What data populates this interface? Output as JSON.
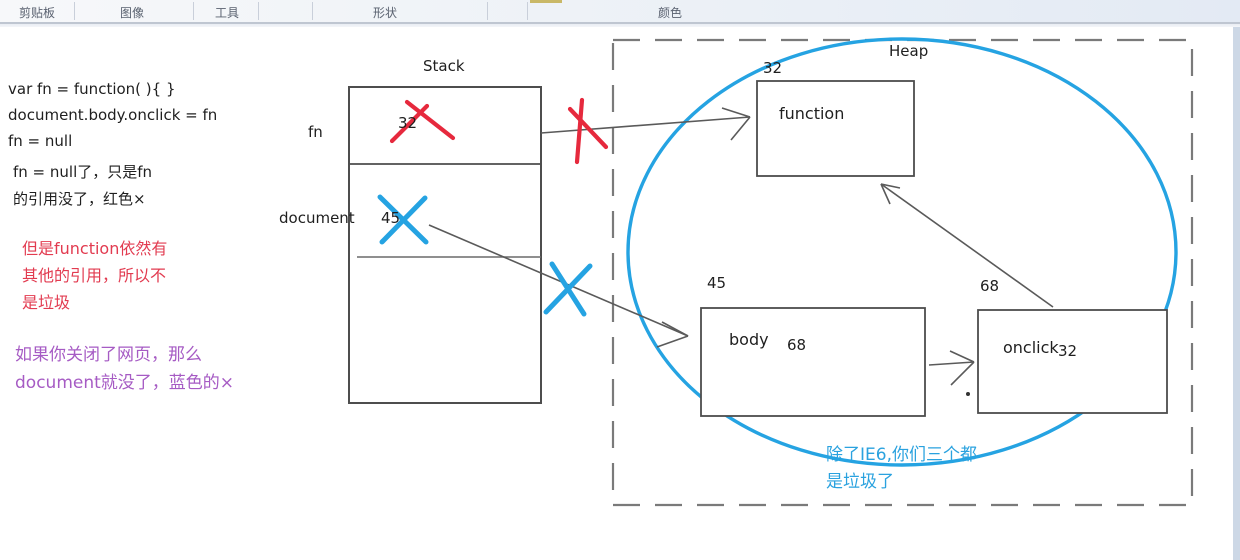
{
  "toolbar": {
    "groups": [
      "剪贴板",
      "图像",
      "工具",
      "形状",
      "颜色"
    ]
  },
  "notes": {
    "code": [
      "var fn = function( ){ }",
      "document.body.onclick = fn",
      "fn = null",
      "fn = null了，只是fn",
      "的引用没了，红色×"
    ],
    "red": [
      "但是function依然有",
      "其他的引用，所以不",
      "是垃圾"
    ],
    "purple": [
      "如果你关闭了网页，那么",
      "document就没了，蓝色的×"
    ],
    "blue": [
      "除了IE6,你们三个都",
      "是垃圾了"
    ]
  },
  "stack": {
    "title": "Stack",
    "slots": [
      {
        "name": "fn",
        "value": "32"
      },
      {
        "name": "document",
        "value": "45"
      }
    ]
  },
  "heap": {
    "title": "Heap",
    "objects": [
      {
        "address": "32",
        "label": "function",
        "ref": ""
      },
      {
        "address": "45",
        "label": "body",
        "ref": "68"
      },
      {
        "address": "68",
        "label": "onclick",
        "ref": "32"
      }
    ]
  },
  "colors": {
    "ink_blue": "#25a3e2",
    "ink_red": "#e6293d",
    "note_red": "#e23b50",
    "note_purple": "#a65bc4",
    "box_border": "#4d4d4d"
  }
}
